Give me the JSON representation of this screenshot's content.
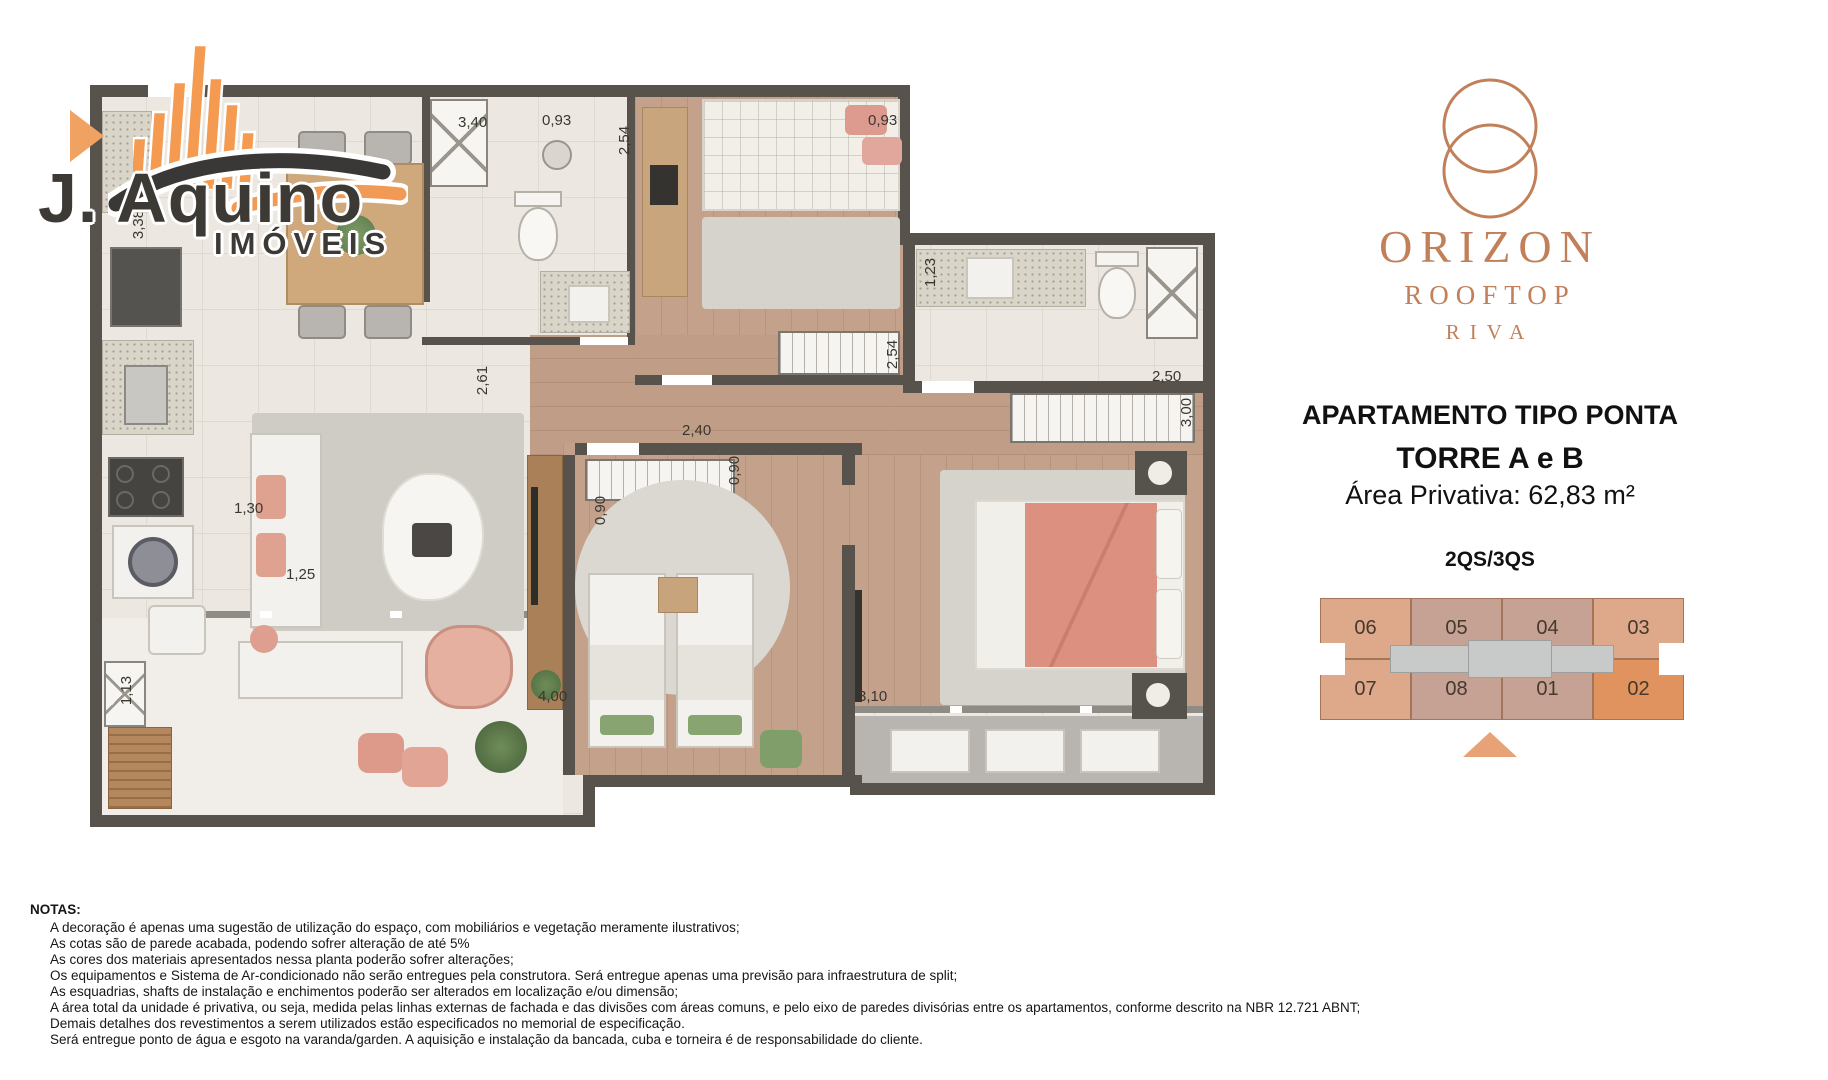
{
  "watermark": {
    "brand": "J. Aquino",
    "subtitle": "IMÓVEIS",
    "colors": {
      "orange": "#F59B51",
      "dark": "#3D3A36"
    }
  },
  "project": {
    "name": "ORIZON",
    "line2": "ROOFTOP",
    "line3": "RIVA",
    "brand_color": "#C2805A"
  },
  "info": {
    "title": "APARTAMENTO TIPO PONTA",
    "tower": "TORRE A e B",
    "area": "Área Privativa: 62,83 m²",
    "config": "2QS/3QS"
  },
  "keyplan": {
    "units": [
      "06",
      "05",
      "04",
      "03",
      "07",
      "08",
      "01",
      "02"
    ],
    "highlighted_units": [
      "06",
      "07",
      "03",
      "02"
    ],
    "featured_unit": "02",
    "colors": {
      "end_unit": "#DEA98B",
      "middle_unit": "#C5A294",
      "featured": "#E0935F",
      "corridor": "#C7CAC9",
      "pointer": "#E8A277"
    }
  },
  "plan": {
    "dimensions": [
      "3,40",
      "0,93",
      "2,54",
      "0,93",
      "1,23",
      "2,50",
      "3,00",
      "2,54",
      "2,61",
      "0,90",
      "0,90",
      "2,40",
      "3,38",
      "1,30",
      "1,25",
      "4,00",
      "3,10",
      "1,13"
    ]
  },
  "notes": {
    "heading": "NOTAS:",
    "lines": [
      "A decoração é apenas uma sugestão de utilização do espaço, com mobiliários e vegetação meramente ilustrativos;",
      "As cotas são de parede acabada, podendo sofrer alteração de até 5%",
      "As cores dos materiais apresentados nessa planta poderão sofrer alterações;",
      "Os equipamentos e Sistema de Ar-condicionado não serão entregues pela construtora. Será entregue apenas uma previsão para infraestrutura de split;",
      "As esquadrias, shafts de instalação e enchimentos poderão ser alterados em localização e/ou dimensão;",
      "A área total da unidade é privativa, ou seja, medida pelas linhas externas de fachada e das divisões com áreas comuns, e pelo eixo de paredes divisórias entre os apartamentos, conforme descrito na NBR 12.721 ABNT;",
      "Demais detalhes dos revestimentos a serem utilizados estão especificados no memorial de especificação.",
      "Será entregue ponto de água e esgoto na varanda/garden. A aquisição e instalação da bancada, cuba e torneira é de responsabilidade do cliente."
    ]
  }
}
